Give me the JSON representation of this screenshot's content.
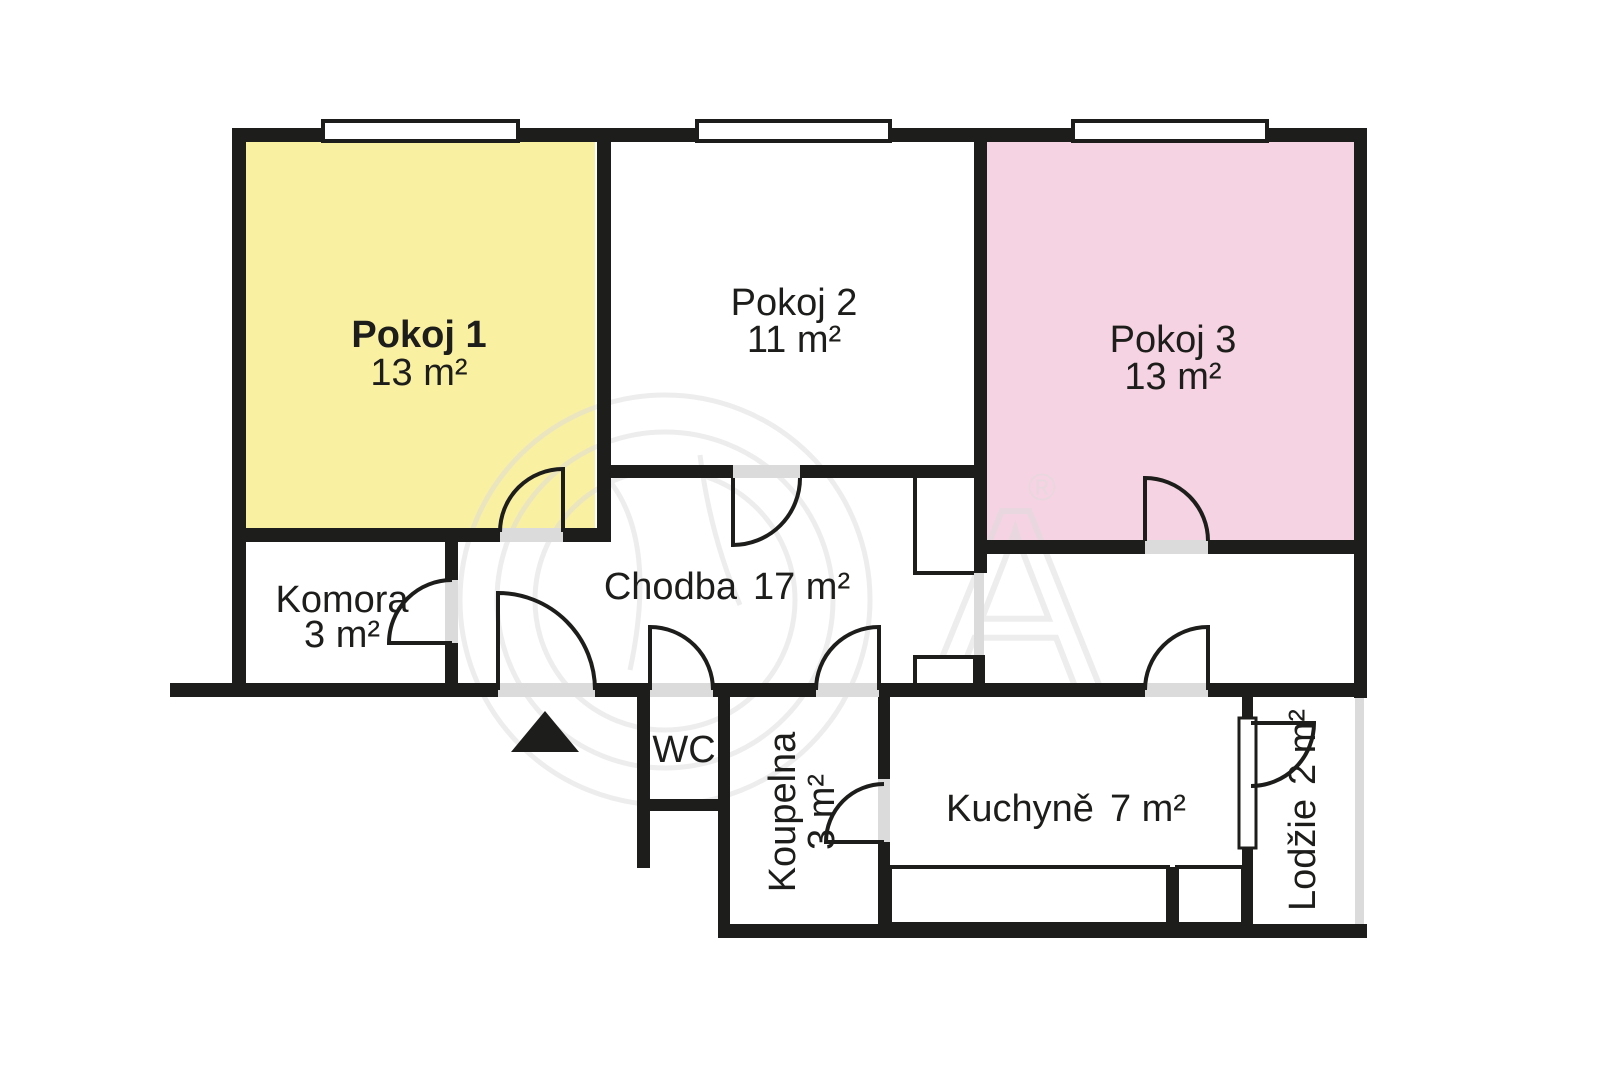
{
  "floor_plan": {
    "rooms": [
      {
        "name": "Pokoj 1",
        "area": "13 m²",
        "fill": "#F9F0A2"
      },
      {
        "name": "Pokoj 2",
        "area": "11 m²",
        "fill": "#FFFFFF"
      },
      {
        "name": "Pokoj 3",
        "area": "13 m²",
        "fill": "#F6D3E2"
      },
      {
        "name": "Komora",
        "area": "3 m²",
        "fill": "#FFFFFF"
      },
      {
        "name": "Chodba",
        "area": "17 m²",
        "fill": "#FFFFFF"
      },
      {
        "name": "WC",
        "area": "",
        "fill": "#FFFFFF"
      },
      {
        "name": "Koupelna",
        "area": "3 m²",
        "fill": "#FFFFFF"
      },
      {
        "name": "Kuchyně",
        "area": "7 m²",
        "fill": "#FFFFFF"
      },
      {
        "name": "Lodžie",
        "area": "2 m²",
        "fill": "#FFFFFF"
      }
    ],
    "colors": {
      "wall": "#1D1D1B",
      "opening": "#DBDBDB",
      "text": "#1D1D1B",
      "watermark": "#DCDCDC"
    },
    "watermark": {
      "symbol": "®",
      "letter": "A"
    },
    "entrance_marker": "▲"
  }
}
